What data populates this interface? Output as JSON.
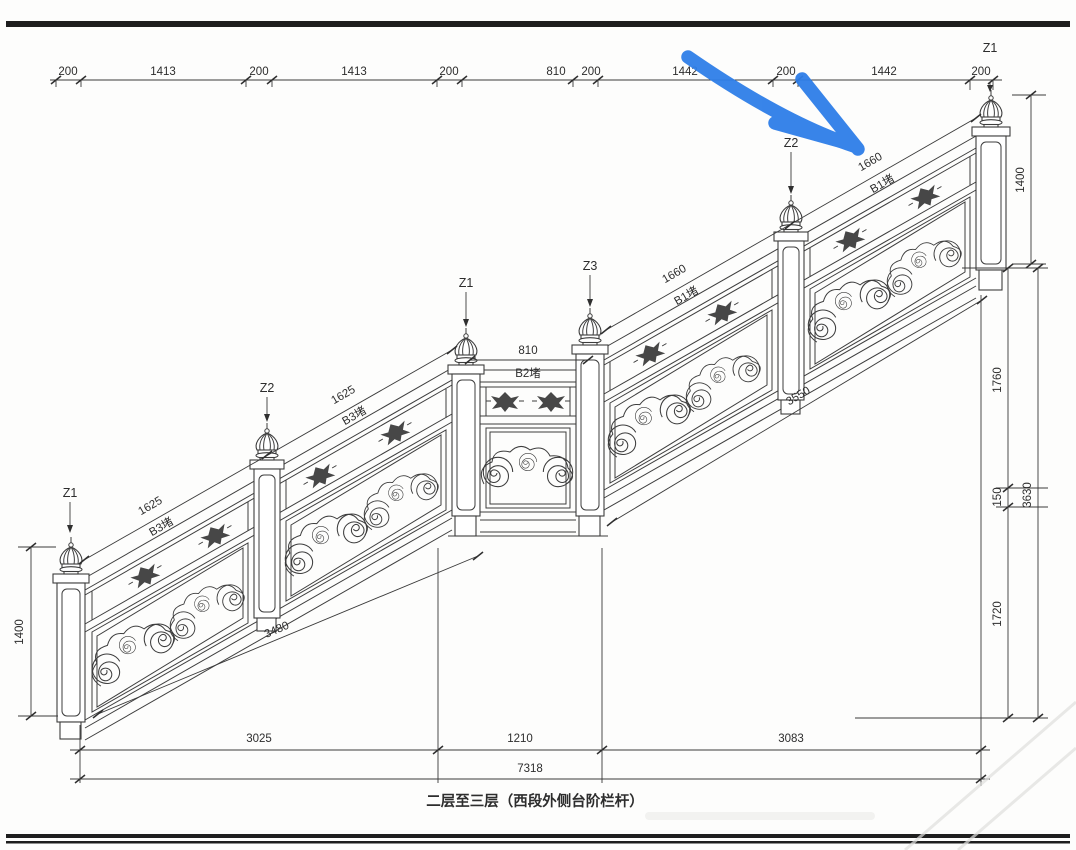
{
  "drawing_title": "二层至三层（西段外侧台阶栏杆）",
  "top_dimension_chain": [
    "200",
    "1413",
    "200",
    "1413",
    "200",
    "810",
    "200",
    "1442",
    "200",
    "1442",
    "200"
  ],
  "posts": [
    {
      "label": "Z1"
    },
    {
      "label": "Z2"
    },
    {
      "label": "Z1"
    },
    {
      "label": "Z3"
    },
    {
      "label": "Z2"
    },
    {
      "label": "Z1"
    }
  ],
  "left_dimensions": {
    "post_height": "1400"
  },
  "right_dimensions": {
    "post_height": "1400",
    "upper_rise": "1760",
    "landing_edge": "150",
    "lower_rise": "1720",
    "total_rise": "3630"
  },
  "bottom_dimensions": {
    "lower_run": "3025",
    "landing_run": "1210",
    "upper_run": "3083",
    "total_run": "7318"
  },
  "sloped_dimensions": {
    "lower_bay_1": {
      "length": "1625",
      "panel": "B3堵"
    },
    "lower_bay_2": {
      "length": "1625",
      "panel": "B3堵"
    },
    "lower_total": "3480",
    "landing_bay": {
      "length": "810",
      "panel": "B2堵"
    },
    "upper_bay_1": {
      "length": "1660",
      "panel": "B1堵"
    },
    "upper_bay_2": {
      "length": "1660",
      "panel": "B1堵"
    },
    "upper_total": "3550"
  },
  "annotation": {
    "arrow_color": "#2e7ee8"
  }
}
